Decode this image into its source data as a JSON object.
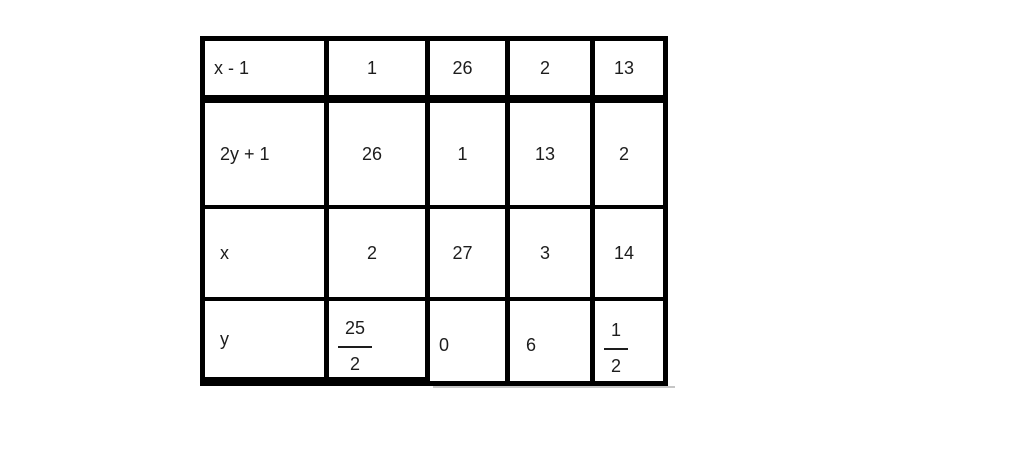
{
  "page": {
    "background_color": "#ffffff"
  },
  "table": {
    "border_color": "#000000",
    "text_color": "#1d1d1d",
    "rows": [
      {
        "label": "x - 1",
        "values": [
          "1",
          "26",
          "2",
          "13"
        ]
      },
      {
        "label": "2y + 1",
        "values": [
          "26",
          "1",
          "13",
          "2"
        ]
      },
      {
        "label": "x",
        "values": [
          "2",
          "27",
          "3",
          "14"
        ]
      },
      {
        "label": "y",
        "values": [
          {
            "num": "25",
            "den": "2"
          },
          "0",
          "6",
          {
            "num": "1",
            "den": "2"
          }
        ]
      }
    ]
  },
  "chart_data": {
    "type": "table",
    "title": "",
    "row_labels": [
      "x - 1",
      "2y + 1",
      "x",
      "y"
    ],
    "rows": [
      [
        "x - 1",
        "1",
        "26",
        "2",
        "13"
      ],
      [
        "2y + 1",
        "26",
        "1",
        "13",
        "2"
      ],
      [
        "x",
        "2",
        "27",
        "3",
        "14"
      ],
      [
        "y",
        "25/2",
        "0",
        "6",
        "1/2"
      ]
    ]
  }
}
